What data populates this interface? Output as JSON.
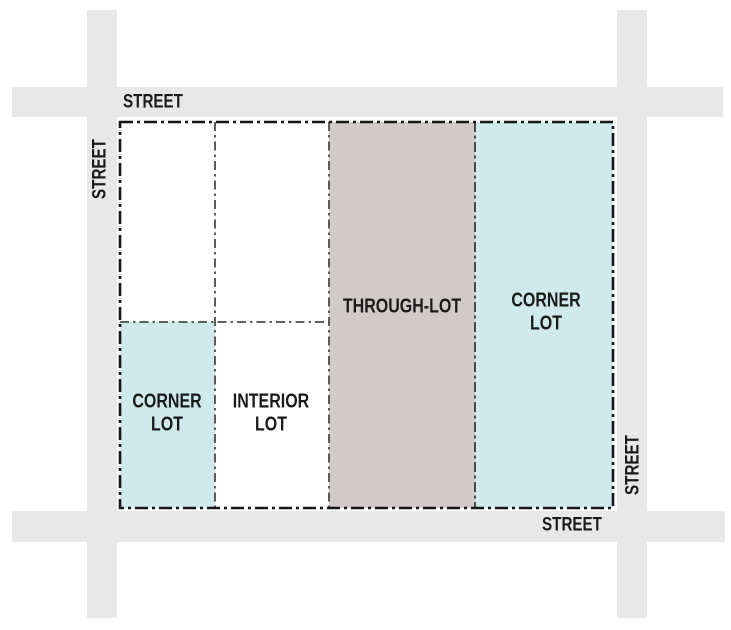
{
  "diagram": {
    "type": "lot-types-block-diagram",
    "street_labels": {
      "top": "STREET",
      "left": "STREET",
      "right": "STREET",
      "bottom": "STREET"
    },
    "lots": {
      "through": {
        "label": "THROUGH-LOT"
      },
      "corner_ne": {
        "line1": "CORNER",
        "line2": "LOT"
      },
      "corner_sw": {
        "line1": "CORNER",
        "line2": "LOT"
      },
      "interior": {
        "line1": "INTERIOR",
        "line2": "LOT"
      }
    }
  },
  "colors": {
    "street_fill": "#e8e8e8",
    "through_lot_fill": "#d0cac8",
    "corner_lot_fill": "#cfe9ec",
    "open_lot_fill": "#ffffff",
    "block_outline": "#161616",
    "lot_divider": "#4a4a4a",
    "label_text": "#1a1a1a"
  }
}
